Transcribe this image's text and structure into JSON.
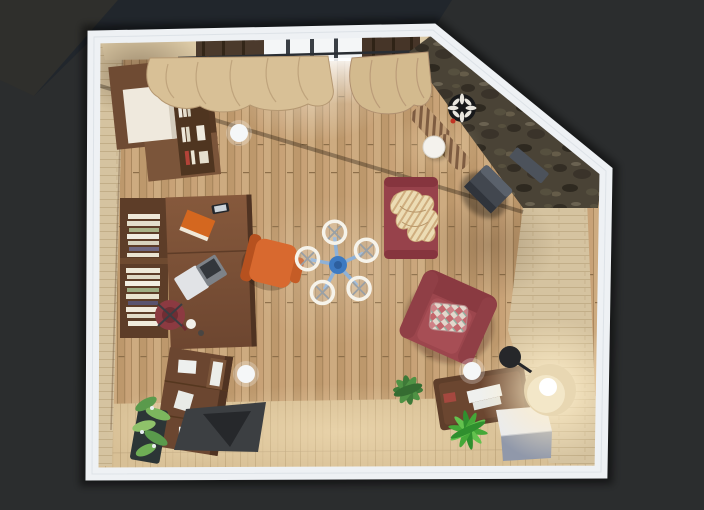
{
  "scene": {
    "name": "3d-floor-plan-top-view",
    "description": "Top-down 3D render of a living room / home office with a cut diagonal corner wall",
    "room_shape": "pentagon-with-diagonal-corner"
  },
  "palette": {
    "background": "#2b2d2e",
    "background_cool": "#20262b",
    "background_warm": "#2f2f2c",
    "wall_band": "#eef1f4",
    "wall_face": "#d5c3a0",
    "top_wall": "#dbc9a5",
    "stone_base": "#4a4336",
    "floor_wood": "#c6a176",
    "floor_light": "#d8c096",
    "rug": "#3c3f42",
    "rug_inner": "#26282b",
    "walnut_dark": "#5d3d28",
    "walnut_mid": "#6b4630",
    "desk_wood": "#7d5338",
    "daybed_red": "#97424b",
    "armchair_red": "#9c464d",
    "task_chair_red": "#8c3a41",
    "chair_orange": "#d8692f",
    "blanket_tan": "#ecdcb4",
    "curtain_tan": "#d8c096",
    "plant_green": "#3e7a38",
    "plant_bright": "#45a838",
    "planter_dark": "#2c3536",
    "ottoman_top": "#e9ebf0",
    "ottoman_side": "#9098aa",
    "lamp_shade": "#e8d7b2",
    "stove_gray": "#42474f",
    "fan_blue": "#3d7ac2",
    "light_white": "#f5f7f8",
    "clock_black": "#17181a",
    "window_white": "#f4f6f7",
    "laptop_silver": "#e1e3e6",
    "book_cream": "#efe9d9",
    "book_green": "#9fae85",
    "book_plum": "#6e6781",
    "accent_red": "#b34338"
  },
  "items": {
    "wardrobe": "wardrobe cabinet",
    "wall_shelf": "wall shelf with books",
    "bookshelf": "bookshelf",
    "desk": "writing desk",
    "laptop": "laptop",
    "desk_lamp": "desk lamp",
    "office_chair": "orange office chair",
    "task_chair": "red task chair",
    "sideboard": "sideboard",
    "planter": "planter with plant",
    "rug": "dark rug",
    "ceiling_fan": "ceiling fan with lights",
    "daybed": "red daybed",
    "blanket": "striped throw blanket",
    "bench": "striped fireplace bench",
    "side_table": "round side table",
    "stove": "wood stove",
    "wall_clock": "round wall clock",
    "armchair": "red armchair",
    "pillow": "patterned pillow",
    "coffee_table": "coffee table",
    "plant_a": "leafy plant",
    "plant_b": "spiky plant",
    "ottoman": "cube ottoman",
    "floor_lamp": "floor lamp",
    "ceiling_light": "ceiling light marker",
    "window": "window with curtains",
    "stone_wall": "stone accent wall"
  }
}
